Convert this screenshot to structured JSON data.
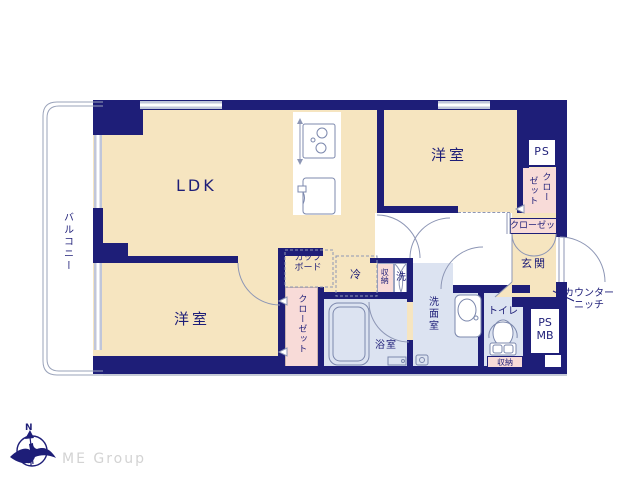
{
  "plan": {
    "labels": {
      "balcony": "バルコニー",
      "ldk": "LDK",
      "bedroom_top_right": "洋室",
      "bedroom_bottom_left": "洋室",
      "ps": "PS",
      "closet_tr_col_right": "クロー",
      "closet_tr_col_left": "ゼット",
      "closet_bar": "クローゼット",
      "entrance": "玄関",
      "counter_niche_line1": "カウンター",
      "counter_niche_line2": "ニッチ",
      "ps_mb_line1": "PS",
      "ps_mb_line2": "MB",
      "toilet": "トイレ",
      "toilet_storage": "収納",
      "storage_strip": "収納",
      "washer": "洗",
      "washroom": "洗面室",
      "bathroom": "浴室",
      "fridge": "冷",
      "cupboard_line1": "カップ",
      "cupboard_line2": "ボード",
      "closet_bottom_left": "クローゼット"
    },
    "colors": {
      "wall": "#1e1e78",
      "room_cream": "#f6e5c0",
      "wet_blue": "#dce3f1",
      "closet_pink": "#f8dbd8",
      "window_gray": "#c0c6da"
    }
  },
  "logo": {
    "company": "ME Group",
    "compass_north": "N"
  }
}
